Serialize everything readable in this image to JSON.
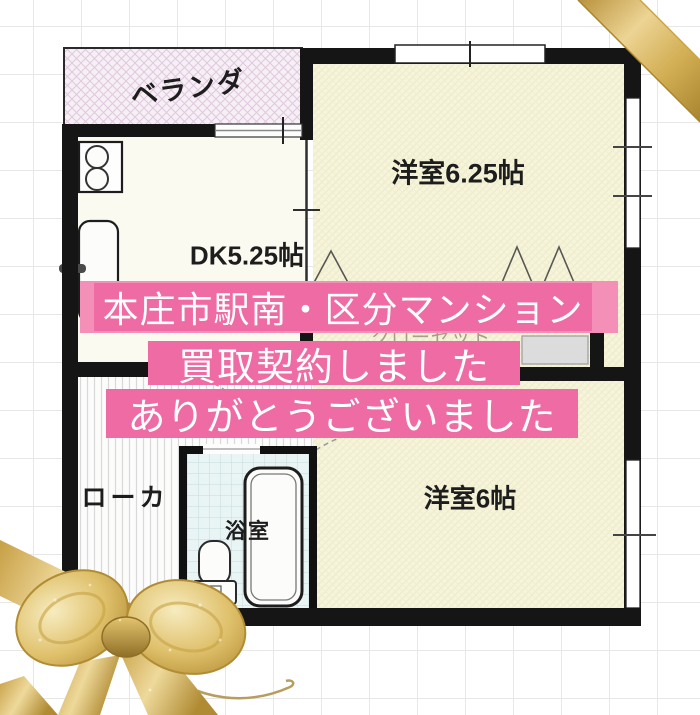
{
  "floorplan": {
    "veranda_label": "ベランダ",
    "room1_label": "洋室6.25帖",
    "dk_label": "DK5.25帖",
    "closet_label": "クローゼット",
    "corridor_label": "ローカ",
    "bath_label": "浴室",
    "room2_label": "洋室6帖"
  },
  "overlay_banner": {
    "line1": "本庄市駅南・区分マンション",
    "line2": "買取契約しました",
    "line3": "ありがとうございました",
    "text_color": "#ffffff",
    "background_color": "#ef6ba4",
    "background_color_light": "#f48fb8"
  },
  "colors": {
    "wall": "#151515",
    "room_fill": "#f6f4d9",
    "dk_fill": "#fbfaf0",
    "veranda_fill": "#f7eff6",
    "bath_fill": "#e9f4f4",
    "corridor_fill": "#fcfcfb",
    "closet_door": "#dcdcdc",
    "grid_line": "#e7e7e7",
    "ribbon_gold": "#d8b55a"
  }
}
